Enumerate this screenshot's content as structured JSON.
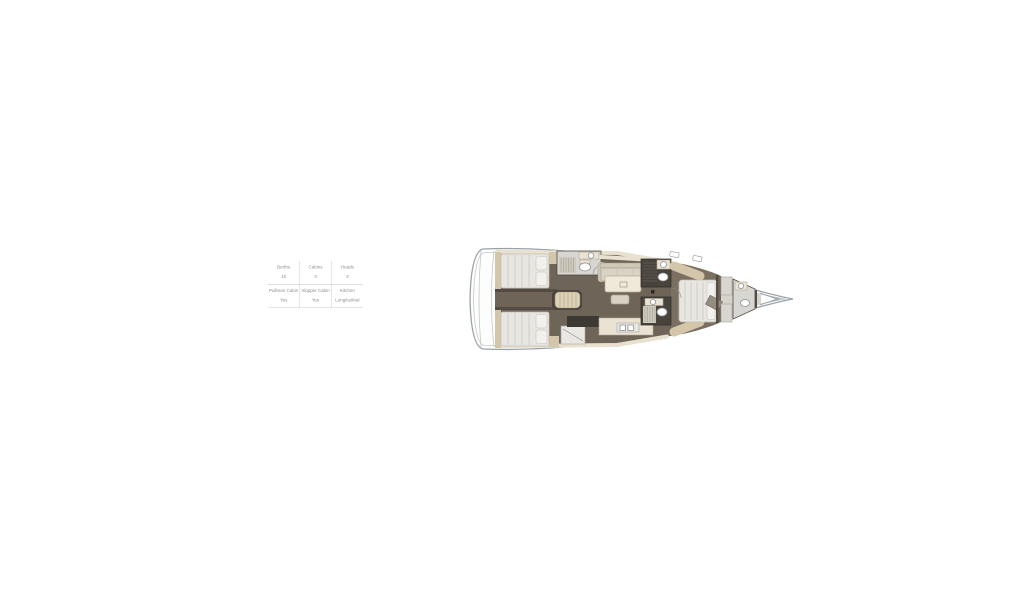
{
  "palette": {
    "hull_outline": "#9aa1a7",
    "hull_inner": "#c3c8cc",
    "floor_dark": "#6e6458",
    "floor_forward": "#7b6f62",
    "wall_tan": "#d3c6aa",
    "wall_dark": "#524c44",
    "bed": "#e8e6e1",
    "bed_line": "#c3bfb6",
    "pillow": "#f2f1ee",
    "sofa": "#d8d2c4",
    "counter": "#eae3d3",
    "counter_dark": "#3c3935",
    "stairs": "#ddd1b6",
    "fixture_stroke": "#8e9296",
    "table_text": "#8f8f8f",
    "table_line": "#cccccc"
  },
  "spec_table": {
    "rows": [
      {
        "cells": [
          {
            "label": "Berths",
            "value": "10"
          },
          {
            "label": "Cabins",
            "value": "3"
          },
          {
            "label": "Heads",
            "value": "3"
          }
        ]
      },
      {
        "cells": [
          {
            "label": "Pullman Cabin",
            "value": "Yes"
          },
          {
            "label": "Skipper Cabin",
            "value": "Yes"
          },
          {
            "label": "Kitchen",
            "value": "Longitudinal"
          }
        ]
      }
    ]
  }
}
